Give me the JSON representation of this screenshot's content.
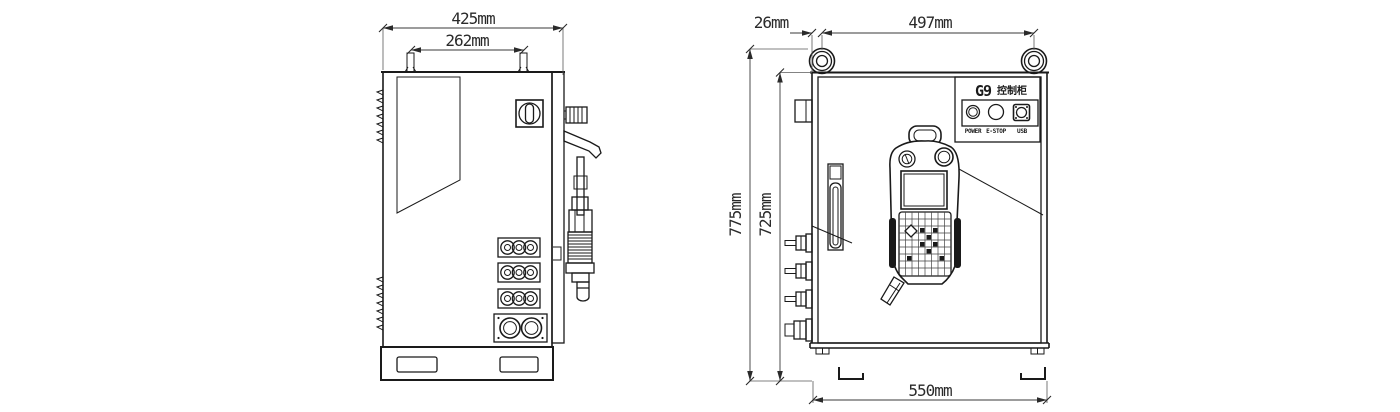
{
  "drawing": {
    "background_color": "#ffffff",
    "line_color": "#1a1a1a",
    "type": "technical drawing, control cabinet, two orthographic views"
  },
  "left_view": {
    "name": "side-view",
    "dims": {
      "overall_depth": "425mm",
      "lug_spacing": "262mm"
    }
  },
  "right_view": {
    "name": "front-view",
    "dims": {
      "eye_offset": "26mm",
      "eye_spacing": "497mm",
      "overall_height": "775mm",
      "cabinet_height": "725mm",
      "base_width": "550mm"
    },
    "panel": {
      "model": "G9",
      "model_label": "控制柜",
      "port_labels": [
        "POWER",
        "E-STOP",
        "USB"
      ]
    }
  }
}
